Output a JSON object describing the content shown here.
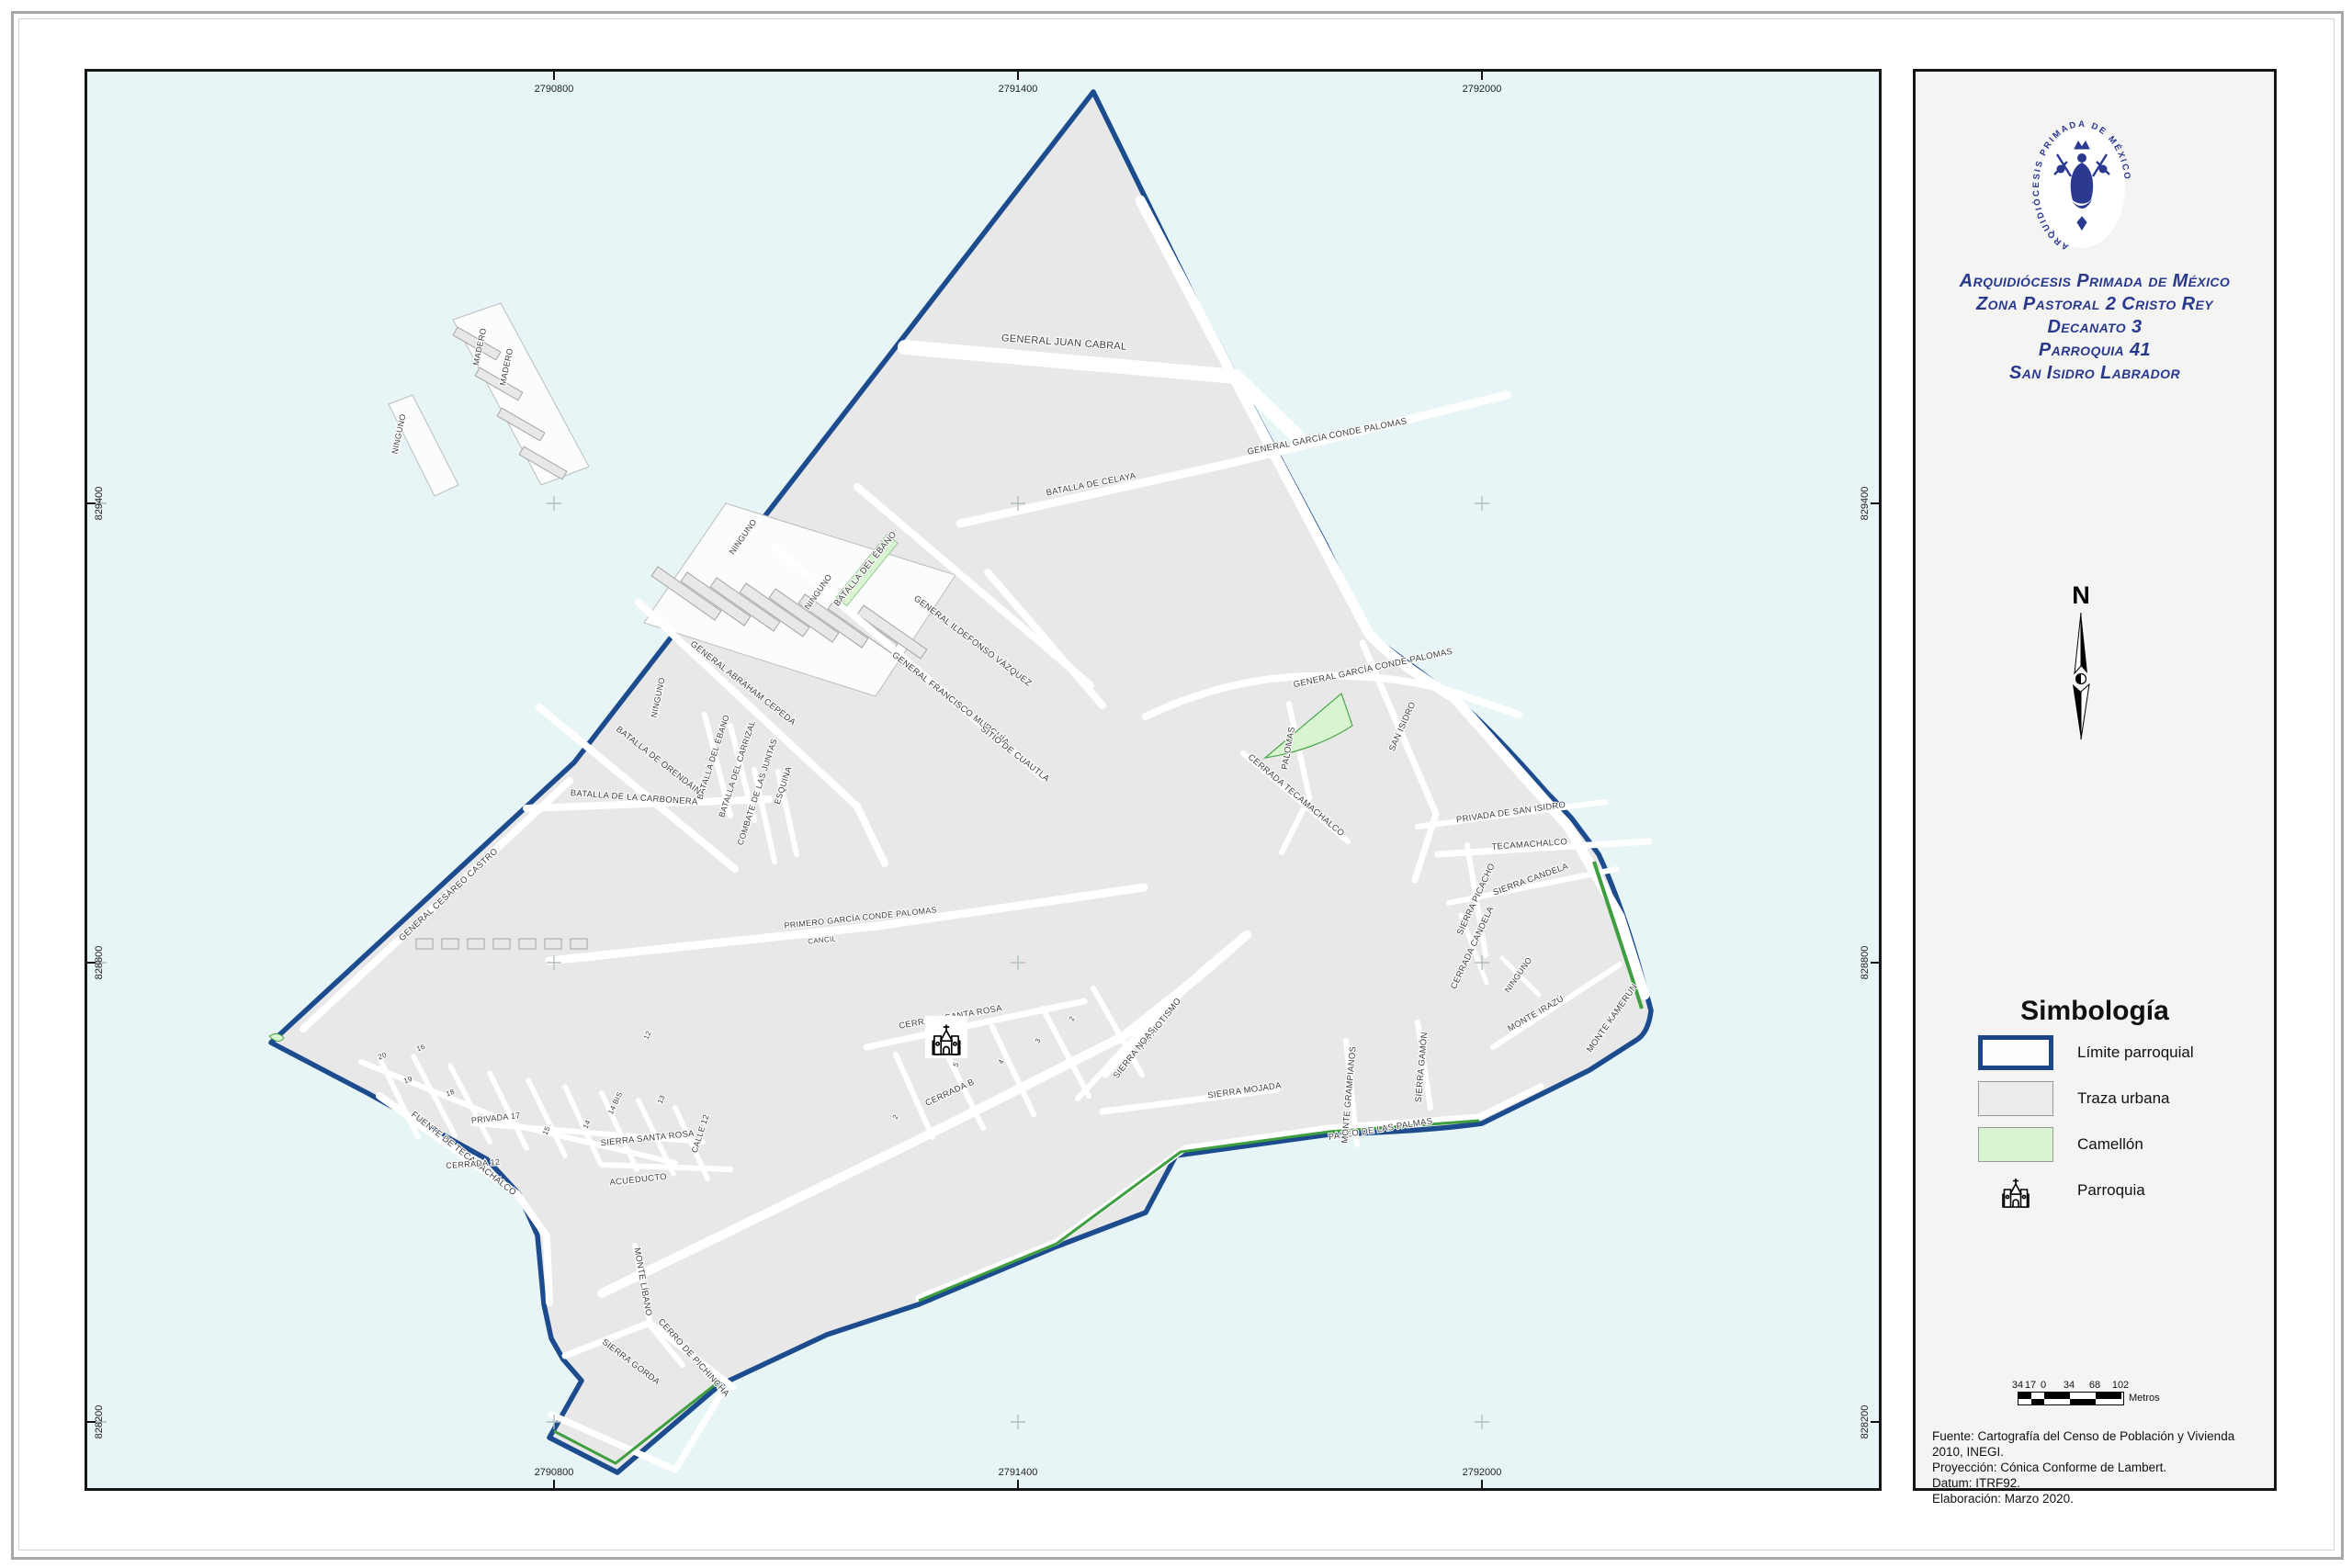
{
  "sidebar": {
    "logo_text": "ARQUIDIÓCESIS PRIMADA DE MÉXICO",
    "title_lines": [
      "Arquidiócesis Primada de México",
      "Zona Pastoral 2 Cristo Rey",
      "Decanato 3",
      "Parroquia 41",
      "San Isidro Labrador"
    ],
    "north_label": "N",
    "legend": {
      "title": "Simbología",
      "items": [
        {
          "label": "Límite parroquial"
        },
        {
          "label": "Traza urbana"
        },
        {
          "label": "Camellón"
        },
        {
          "label": "Parroquia"
        }
      ]
    },
    "scalebar": {
      "labels": [
        "34",
        "17",
        "0",
        "34",
        "68",
        "102"
      ],
      "unit": "Metros"
    },
    "source_lines": [
      "Fuente: Cartografía del Censo de Población y Vivienda 2010, INEGI.",
      "Proyección: Cónica Conforme de Lambert.",
      "Datum: ITRF92.",
      "Elaboración: Marzo 2020."
    ]
  },
  "map": {
    "coords": {
      "top": [
        "2790800",
        "2791400",
        "2792000"
      ],
      "bottom": [
        "2790800",
        "2791400",
        "2792000"
      ],
      "left": [
        "829400",
        "828800",
        "828200"
      ],
      "right": [
        "829400",
        "828800",
        "828200"
      ]
    },
    "streets": [
      {
        "name": "GENERAL JUAN CABRAL"
      },
      {
        "name": "BATALLA DE CELAYA"
      },
      {
        "name": "GENERAL GARCÍA CONDE PALOMAS"
      },
      {
        "name": "GENERAL GARCÍA CONDE PALOMAS"
      },
      {
        "name": "GENERAL ILDEFONSO VÁZQUEZ"
      },
      {
        "name": "GENERAL FRANCISCO MURGUÍA"
      },
      {
        "name": "SITIO DE CUAUTLA"
      },
      {
        "name": "BATALLA DEL ÉBANO"
      },
      {
        "name": "NINGUNO"
      },
      {
        "name": "NINGUNO"
      },
      {
        "name": "NINGUNO"
      },
      {
        "name": "MADERO"
      },
      {
        "name": "MADERO"
      },
      {
        "name": "NINGUNO"
      },
      {
        "name": "GENERAL ABRAHAM CEPEDA"
      },
      {
        "name": "BATALLA DEL ÉBANO"
      },
      {
        "name": "BATALLA DEL CARRIZAL"
      },
      {
        "name": "COMBATE DE LAS JUNTAS"
      },
      {
        "name": "ESQUINA"
      },
      {
        "name": "BATALLA DE ORENDÁIN"
      },
      {
        "name": "BATALLA DE LA CARBONERA"
      },
      {
        "name": "GENERAL CESÁREO CASTRO"
      },
      {
        "name": "FUENTE DE TECAMACHALCO"
      },
      {
        "name": "PRIMERO GARCÍA CONDE PALOMAS"
      },
      {
        "name": "CANCIL"
      },
      {
        "name": "CERRADA SANTA ROSA"
      },
      {
        "name": "CERRADA B"
      },
      {
        "name": "SIERRA SANTA ROSA"
      },
      {
        "name": "ACUEDUCTO"
      },
      {
        "name": "PRIVADA 17"
      },
      {
        "name": "CALLE 12"
      },
      {
        "name": "CERRADA 12"
      },
      {
        "name": "SIERRA GORDA"
      },
      {
        "name": "CERRO DE PICHINCHA"
      },
      {
        "name": "MONTE LÍBANO"
      },
      {
        "name": "PASEO DE LAS PALMAS"
      },
      {
        "name": "SIERRA MOJADA"
      },
      {
        "name": "MONTE GRAMPIANOS"
      },
      {
        "name": "SIERRA GAMÓN"
      },
      {
        "name": "MONTE IRAZÚ"
      },
      {
        "name": "MONTE KAMERÚN"
      },
      {
        "name": "PATRIOTISMO"
      },
      {
        "name": "SIERRA NOAS"
      },
      {
        "name": "SAN ISIDRO"
      },
      {
        "name": "PALOMAS"
      },
      {
        "name": "CERRADA TECAMACHALCO"
      },
      {
        "name": "PRIVADA DE SAN ISIDRO"
      },
      {
        "name": "TECAMACHALCO"
      },
      {
        "name": "SIERRA PICACHO"
      },
      {
        "name": "SIERRA CANDELA"
      },
      {
        "name": "CERRADA CANDELA"
      },
      {
        "name": "NINGUNO"
      }
    ],
    "small_labels": [
      "20",
      "19",
      "18",
      "16",
      "15",
      "14",
      "14 BIS",
      "13",
      "12",
      "5",
      "4",
      "3",
      "2",
      "2"
    ]
  },
  "colors": {
    "boundary": "#1c4b8e",
    "urban_fill": "#e9e8e8",
    "camellon": "#d8f4d0",
    "camellon_edge": "#3f9e3f",
    "map_background": "#e8f5f6",
    "title_navy": "#28398c"
  }
}
